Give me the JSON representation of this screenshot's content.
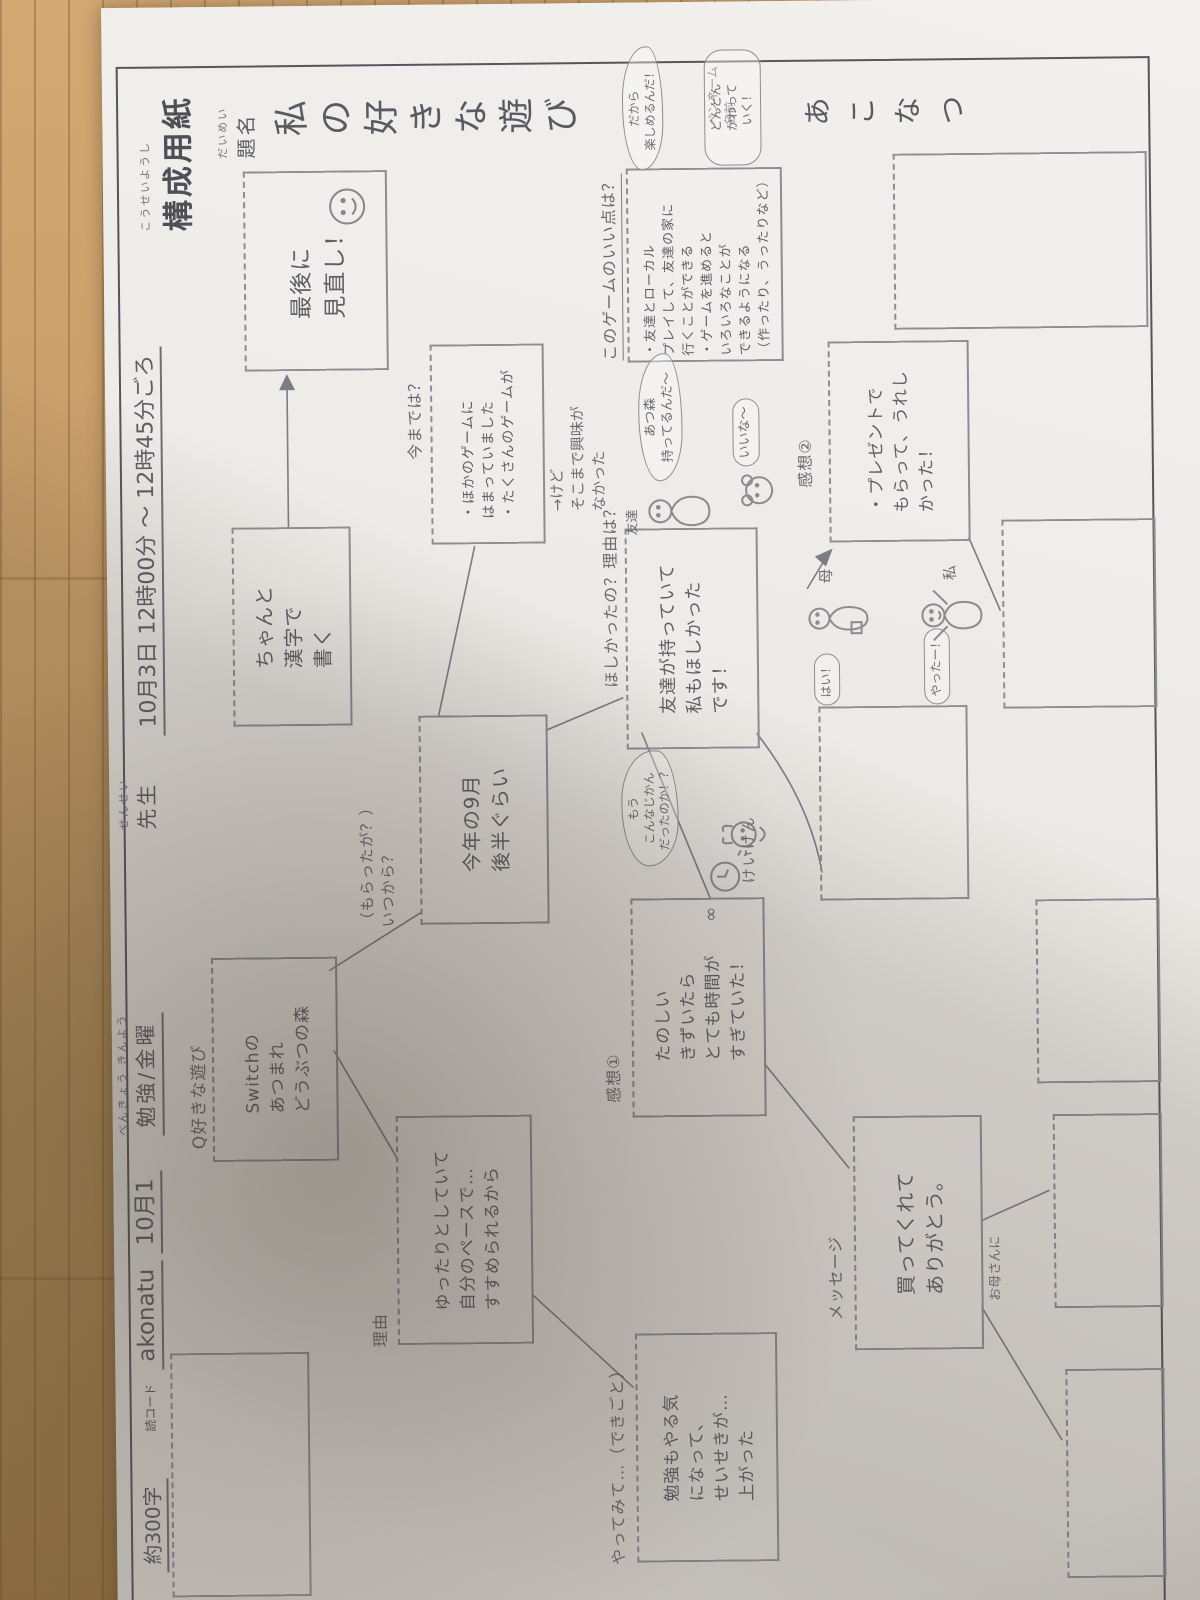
{
  "header": {
    "char_count": "約300字",
    "code_label": "読コード",
    "code_value": "akonatu",
    "date_field": "10月1",
    "subject_ruby": "べんきょう きんよう",
    "subject_field": "勉強/金曜",
    "teacher_ruby": "せんせい",
    "teacher_label": "先生",
    "datetime_field": "10月3日 12時00分 〜 12時45分ごろ",
    "form_title_ruby": "こうせいようし",
    "form_title": "構成用紙"
  },
  "title_block": {
    "label_ruby": "だいめい",
    "label": "題名",
    "title": "私の好きな遊び",
    "penname_label": "ペンネーム\n名前",
    "penname": "あこなつ"
  },
  "flow": {
    "q_label": "Q好きな遊び",
    "q_box": [
      "Switchの",
      "あつまれ",
      "どうぶつの森"
    ],
    "reason_label": "理由",
    "reason_box": [
      "ゆったりとしていて",
      "自分のペースで…",
      "すすめられるから"
    ],
    "when_label": [
      "（もらったが？）",
      "いつから？"
    ],
    "when_box": [
      "今年の9月",
      "後半ぐらい"
    ],
    "until_label": "今までは？",
    "until_box": [
      "・ほかのゲームに",
      "はまっていました",
      "・たくさんのゲームが"
    ],
    "until_note": [
      "→けど",
      "そこまで興味が",
      "なかった"
    ],
    "good_label": "このゲームのいい点は？",
    "good_box": [
      "・友達とローカル",
      "プレイして、友達の家に",
      "行くことができる",
      "・ゲームを進めると",
      "いろいろなことが",
      "できるようになる",
      "（作ったり、うったりなど）"
    ],
    "want_label": "ほしかったの？理由は？",
    "want_box": [
      "友達が持っていて",
      "私もほしかった",
      "です！"
    ],
    "kansou1_label": "感想①",
    "kansou1_box": [
      "たのしい",
      "きずいたら",
      "とても時間が",
      "すぎていた！"
    ],
    "kansou2_label": "感想②",
    "kansou2_box": [
      "・プレゼントで",
      "もらって、うれし",
      "かった！"
    ],
    "try_label": "やってみて…（できごと）",
    "try_box": [
      "勉強もやる気",
      "になって、",
      "せいせきが…",
      "上がった"
    ],
    "message_label": "メッセージ",
    "message_box": [
      "買ってくれて",
      "ありがとう。"
    ],
    "message_note": "お母さんに",
    "keiken_label": "けいけん",
    "kanji_box": [
      "ちゃんと",
      "漢字で",
      "書く"
    ],
    "final_box": [
      "最後に",
      "見直し！"
    ]
  },
  "doodles": {
    "friend_label": "友達",
    "friend_bubble": [
      "あつ森",
      "持ってるんだ〜"
    ],
    "envy_bubble": "いいな〜",
    "mom_label": "母",
    "mom_bubble": "はい！",
    "me_label": "私",
    "me_bubble": "やったー！",
    "clock_bubble": [
      "もう",
      "こんなじかん",
      "だったのか！？"
    ],
    "cloud_note": [
      "だから",
      "楽しめるんだ！"
    ],
    "change_note": [
      "どんどん",
      "かわって",
      "いく！"
    ],
    "infinity_mark": "∞"
  },
  "colors": {
    "paper": "#ebe8e4",
    "pencil": "#63636b",
    "printed_border": "#55555c",
    "wood_floor": "#c79d67"
  }
}
